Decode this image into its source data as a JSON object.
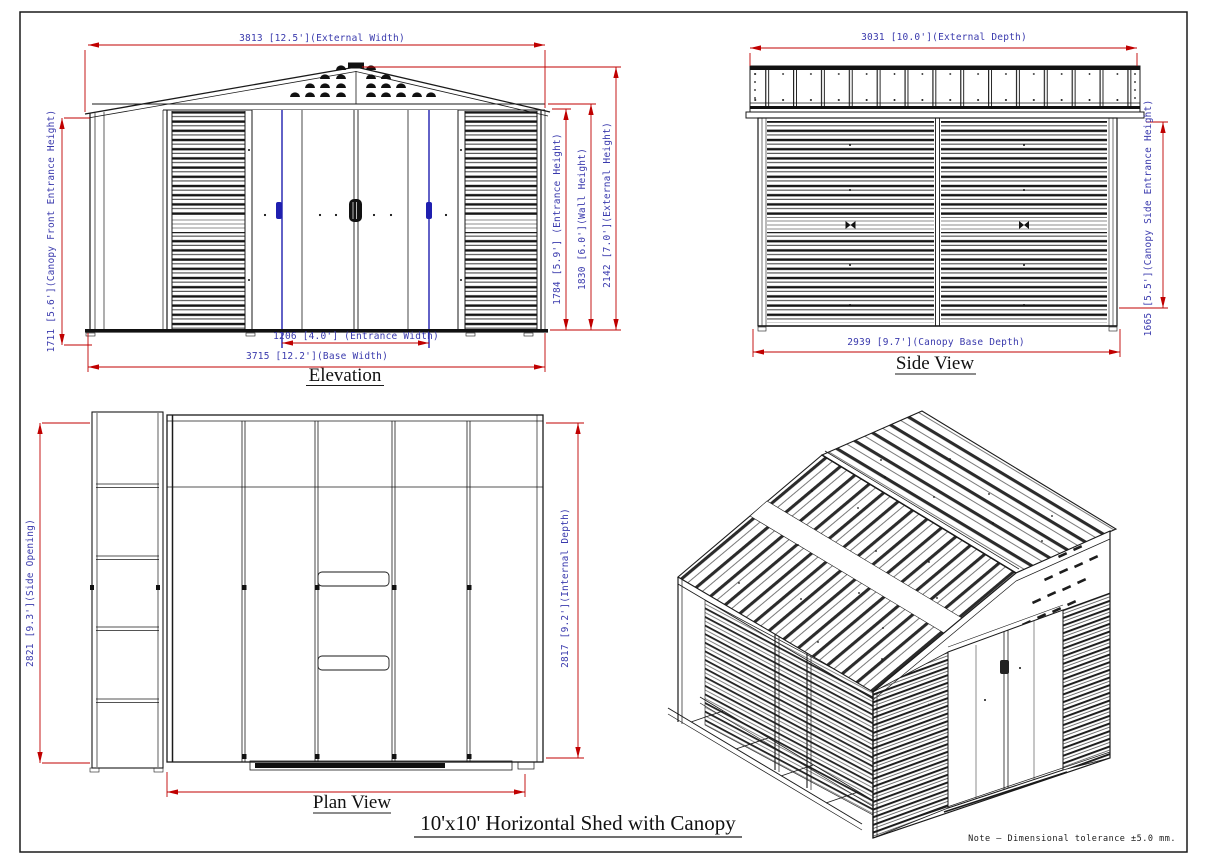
{
  "sheet": {
    "title": "10'x10'  Horizontal Shed with Canopy",
    "note": "Note – Dimensional tolerance ±5.0 mm.",
    "colors": {
      "dimension_line": "#c00000",
      "dimension_text": "#3a3aad",
      "door_accent": "#1f1faf",
      "drawing_line": "#1a1a1a",
      "background": "#ffffff"
    }
  },
  "views": {
    "elevation": {
      "label": "Elevation",
      "dims": {
        "external_width": "3813 [12.5'](External Width)",
        "canopy_front_entrance_height": "1711 [5.6'](Canopy Front Entrance Height)",
        "entrance_height": "1784 [5.9'] (Entrance Height)",
        "wall_height": "1830 [6.0'](Wall Height)",
        "external_height": "2142 [7.0'](External Height)",
        "entrance_width": "1206 [4.0'] (Entrance Width)",
        "base_width": "3715 [12.2'](Base Width)"
      }
    },
    "side_view": {
      "label": "Side View",
      "dims": {
        "external_depth": "3031 [10.0'](External Depth)",
        "canopy_base_depth": "2939 [9.7'](Canopy Base Depth)",
        "canopy_side_entrance_height": "1665 [5.5'](Canopy Side Entrance Height)"
      }
    },
    "plan_view": {
      "label": "Plan View",
      "dims": {
        "side_opening": "2821 [9.3'](Side Opening)",
        "internal_depth": "2817 [9.2'](Internal Depth)"
      }
    },
    "isometric": {
      "description": "3D view of 10x10 horizontal shed with open canopy frame"
    }
  }
}
